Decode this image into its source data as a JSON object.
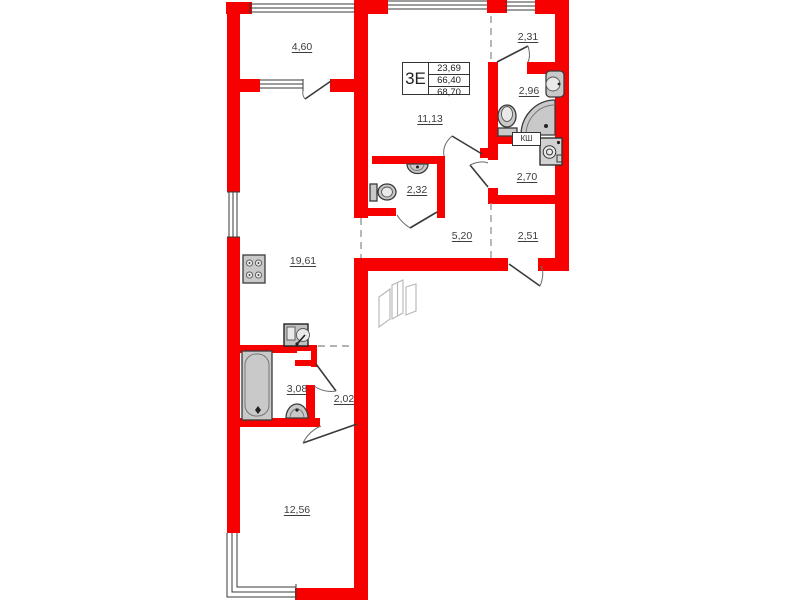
{
  "plan": {
    "stamp": {
      "unit_type": "3Е",
      "values": [
        "23,69",
        "66,40",
        "68,70"
      ]
    },
    "rooms": [
      {
        "id": "loggia",
        "area": "4,60"
      },
      {
        "id": "room-11-13",
        "area": "11,13"
      },
      {
        "id": "hall-2-31",
        "area": "2,31"
      },
      {
        "id": "shower-room",
        "area": "2,96"
      },
      {
        "id": "closet-2-70",
        "area": "2,70"
      },
      {
        "id": "wc",
        "area": "2,32"
      },
      {
        "id": "hallway-5-20",
        "area": "5,20"
      },
      {
        "id": "hall-2-51",
        "area": "2,51"
      },
      {
        "id": "kitchen-living",
        "area": "19,61"
      },
      {
        "id": "bathroom",
        "area": "3,08"
      },
      {
        "id": "hall-2-02",
        "area": "2,02"
      },
      {
        "id": "bedroom",
        "area": "12,56"
      }
    ],
    "closet_label": "КШ",
    "colors": {
      "wall": "#f70000",
      "fixture_fill": "#c9c9c9",
      "fixture_stroke": "#3a3a3a",
      "text": "#3d3d3d"
    }
  }
}
